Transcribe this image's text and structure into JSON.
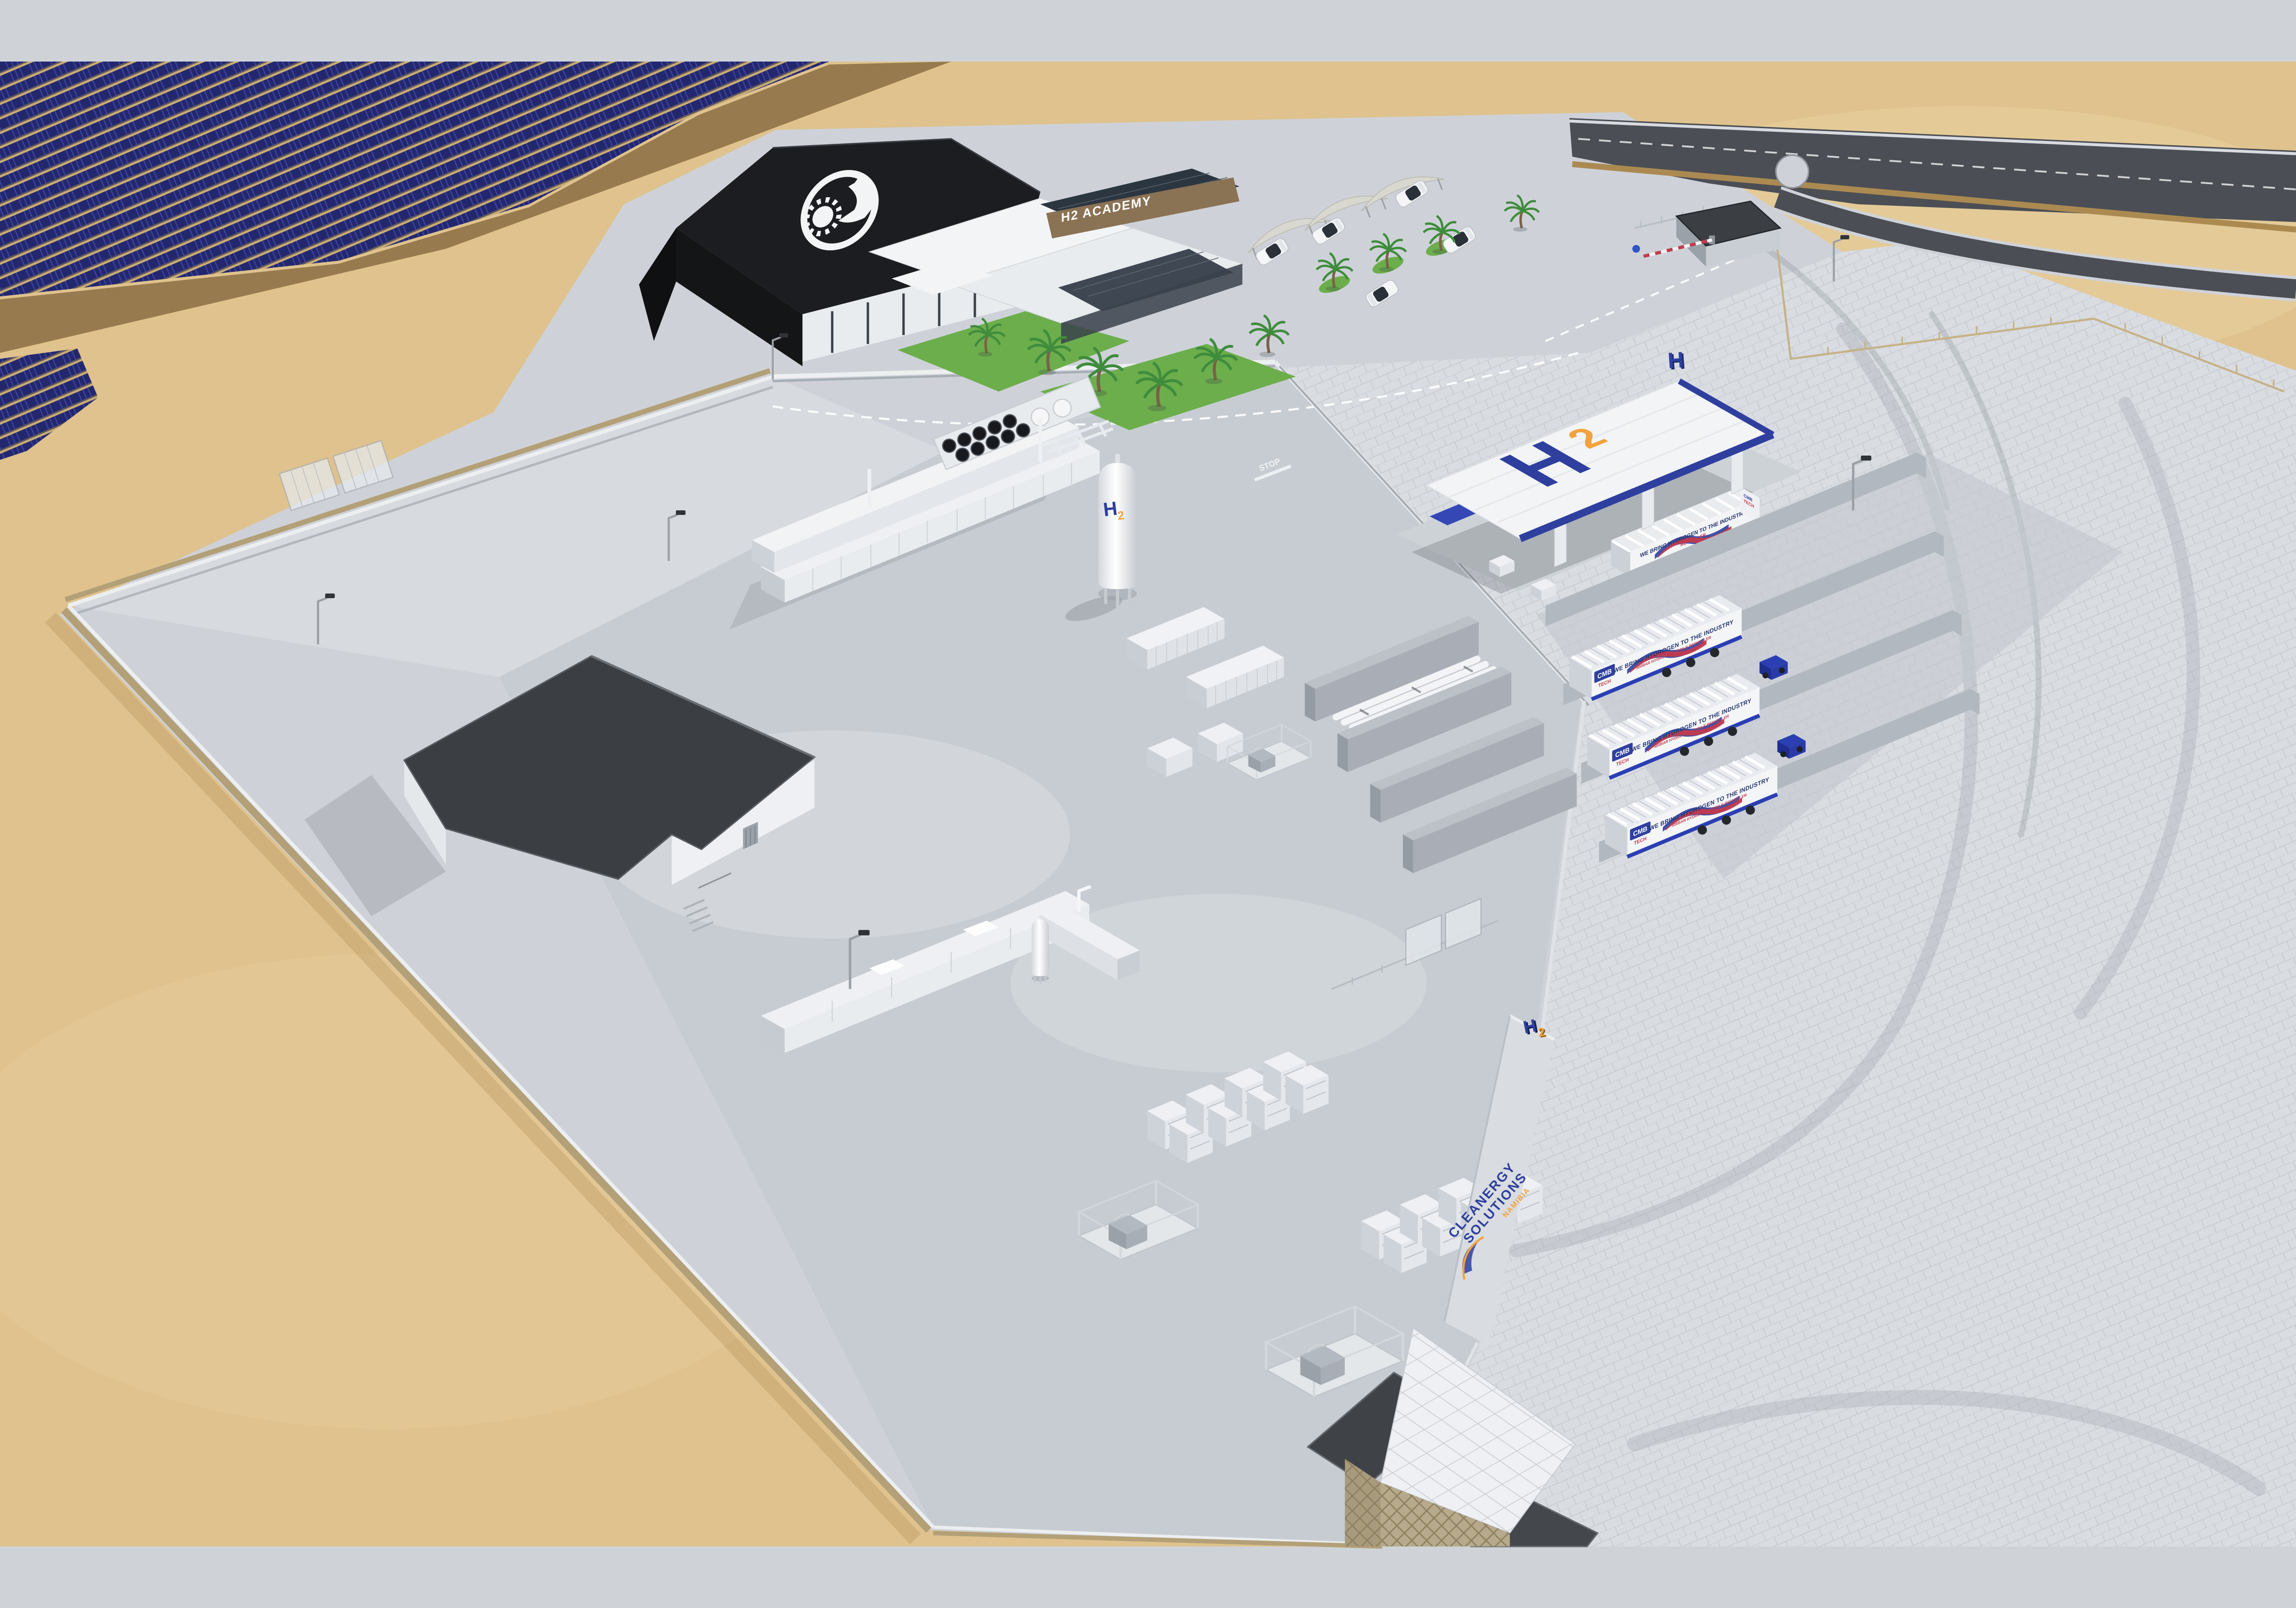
{
  "labels": {
    "academy_sign": "H2 ACADEMY",
    "station_h": "H",
    "station_2": "2",
    "station_roof_sign": "H",
    "tank_h": "H",
    "tank_2": "2",
    "wall_h": "H",
    "wall_2": "2",
    "cmb": "CMB",
    "tech": "TECH",
    "slogan": "WE BRING HYDROGEN TO THE INDUSTRY",
    "slogan_sub": "500BAR HYDROGEN MOBILE REFUELLER",
    "refueller": "REFUELLER",
    "brand_line1": "CLEANERGY",
    "brand_line2": "SOLUTIONS",
    "brand_line3": "NAMIBIA",
    "stop_marking": "STOP"
  },
  "icons": {
    "roof_logo": "sun-and-camel-icon",
    "brand_swoosh": "wave-swoosh-icon",
    "h2_letters": "h2-3d-letters-icon"
  },
  "colors": {
    "sand": "#dfc28d",
    "sandShadow": "#c8ab74",
    "dirt": "#8f7347",
    "solar": "#23286e",
    "solarLight": "#4046a3",
    "asphalt": "#4b4e54",
    "paving": "#ced2d8",
    "pavingLight": "#d9dce1",
    "gravel": "#d7dade",
    "wallTop": "#eceef0",
    "wallTan": "#b3a077",
    "concretePad": "#c6cbd1",
    "white": "#f2f4f6",
    "whiteShade": "#e4e7eb",
    "whiteSide": "#c9ced4",
    "roofDark": "#3b3e43",
    "roofBlack": "#1b1d20",
    "glass": "#2c3640",
    "wood": "#8a7254",
    "grass": "#6cae4c",
    "palm": "#3f8c3c",
    "brandBlue": "#2e3f9e",
    "brandOrange": "#f2a33c",
    "brandRed": "#c23a4c",
    "navy": "#27356f",
    "truckBlue": "#2b3fb3",
    "metal": "#aab0b8",
    "fenceTan": "#c6b286",
    "shadow": "#343a41"
  }
}
